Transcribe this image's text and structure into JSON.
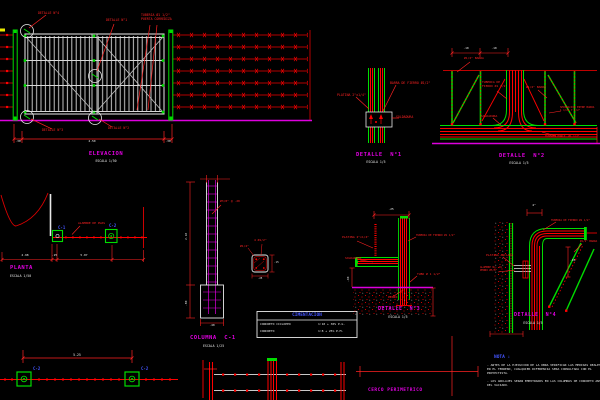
{
  "titles": {
    "elevacion": {
      "t": "ELEVACION",
      "s": "ESCALA 1/50"
    },
    "detalle1": {
      "t": "DETALLE  N°1",
      "s": "ESCALA 1/5"
    },
    "detalle2": {
      "t": "DETALLE  N°2",
      "s": "ESCALA 1/5"
    },
    "planta": {
      "t": "PLANTA",
      "s": "ESCALA 1/50"
    },
    "columna": {
      "t": "COLUMNA  C-1",
      "s": "ESCALA 1/25"
    },
    "detalle3": {
      "t": "DETALLE  N°3",
      "s": "ESCALA 1/5"
    },
    "detalle4": {
      "t": "DETALLE  N°4",
      "s": "ESCALA 1/5"
    },
    "bottom": "CERCO PERIMETRICO"
  },
  "elevation": {
    "callout_d4": "DETALLE N°4",
    "callout_d1": "DETALLE N°1",
    "callout_tuberia": "TUBERIA Ø1 1/2\"\nPUERTA CORREDIZA",
    "callout_d3": "DETALLE N°3",
    "callout_d2": "DETALLE N°2",
    "dim_left": ".30",
    "dim_center": "4.50",
    "dim_right": ".30"
  },
  "planta": {
    "c1": "C-1",
    "c2": "C-2",
    "alambre": "ALAMBRE DE PUAS",
    "dim1": "4.98",
    "dim2": ".25",
    "dim3": "5.07"
  },
  "columna": {
    "rebar": "Ø3/8\" @ .20",
    "dim_h": "2.10",
    "dim_f": ".80",
    "dim_w": ".40",
    "sec_bars": "4 Ø1/2\"",
    "sec_stirrup": "Ø1/4\"",
    "sec_w": ".25",
    "sec_h": ".15"
  },
  "table": {
    "header": "CIMENTACION",
    "r1_name": "CONCRETO CICLOPEO",
    "r1_val": "1:10 + 30% P.G.",
    "r2_name": "CONCRETO",
    "r2_val": "1:8 + 25% P.M."
  },
  "detalle1": {
    "platina": "PLATINA 2\"x1/4\"",
    "barra": "BARRA DE FIERRO Ø1/2\"",
    "soldadura": "SOLDADURA"
  },
  "detalle2": {
    "dim1": ".10",
    "dim2": ".10",
    "barra_top": "Ø1/2\" BARRA",
    "tuberia": "TUBERIA DE\nFIERRO Ø1 1/2\"",
    "barra_right": "Ø1/2\" BARRA",
    "soldadura": "SOLDADURA",
    "separacion": "SEPARACION ENTRE BARRA\n1 1/2\" Y 1/2\"",
    "tuberia_h": "TUBERIA HORIZ. Ø1 1/2\""
  },
  "detalle3": {
    "dim_top": ".25",
    "platina": "PLATINA 2\"x1/4\"",
    "soldadura": "SOLDADURA",
    "tuberia": "TUBERIA DE FIERRO Ø1 1/2\"",
    "tubo": "TUBO Ø 1 1/2\"",
    "perno": "PERNO",
    "dim_left": ".40"
  },
  "detalle4": {
    "dim_top": "4\"",
    "tuberia": "TUBERIA DE FIERRO Ø1 1/2\"",
    "barra": "Ø1/2\" BARRA",
    "platina": "PLATINA ANCLADA",
    "alambre": "ALAMBRE No. 16\nPERNO Ø5/8\"",
    "dim_right": ".45"
  },
  "bottom_plan": {
    "dim": "5.25",
    "c2a": "C-2",
    "c2b": "C-2"
  },
  "nota": {
    "header": "NOTA :",
    "item1": "- ANTES DE LA EJECUCION DE LA OBRA VERIFICAR LAS MEDIDAS REALES EN EL TERRENO, CUALQUIER DIFERENCIA SERA CONSULTADA CON EL PROYECTISTA.",
    "item2": "- LOS ANCLAJES SERAN EMPOTRADOS EN LAS COLUMNAS DE CONCRETO ANTES DEL VACIADO."
  },
  "colors": {
    "background": "#000000",
    "red": "#ff0000",
    "green": "#00dd00",
    "magenta": "#dd00dd",
    "blue": "#4455ff",
    "white": "#e8e8e8",
    "yellow": "#e8e800"
  }
}
